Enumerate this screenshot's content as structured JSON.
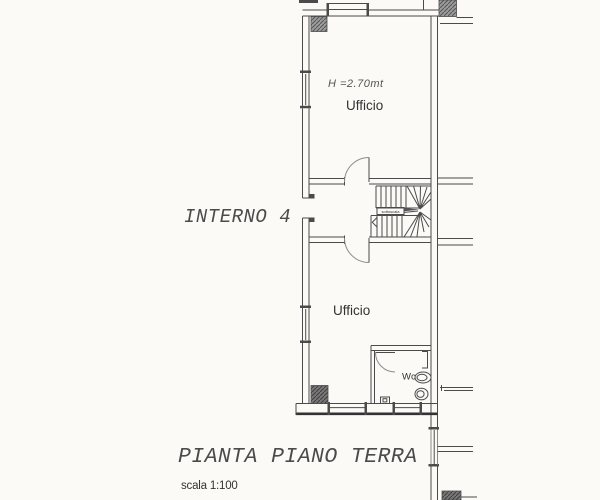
{
  "plan": {
    "unit_label": "INTERNO 4",
    "title": "PIANTA PIANO TERRA",
    "scale_label": "scala 1:100",
    "rooms": {
      "office_top": {
        "label": "Ufficio",
        "ceiling_height": "H =2.70mt"
      },
      "office_bottom": {
        "label": "Ufficio"
      },
      "wc": {
        "label": "Wc"
      },
      "understair": {
        "label": "sottoscala"
      }
    },
    "colors": {
      "paper": "#fbfaf7",
      "ink": "#4b4b4b",
      "wall_dark": "#333333",
      "pillar_fill": "#9c9c9c",
      "pillar_fill_dark": "#787878"
    }
  }
}
